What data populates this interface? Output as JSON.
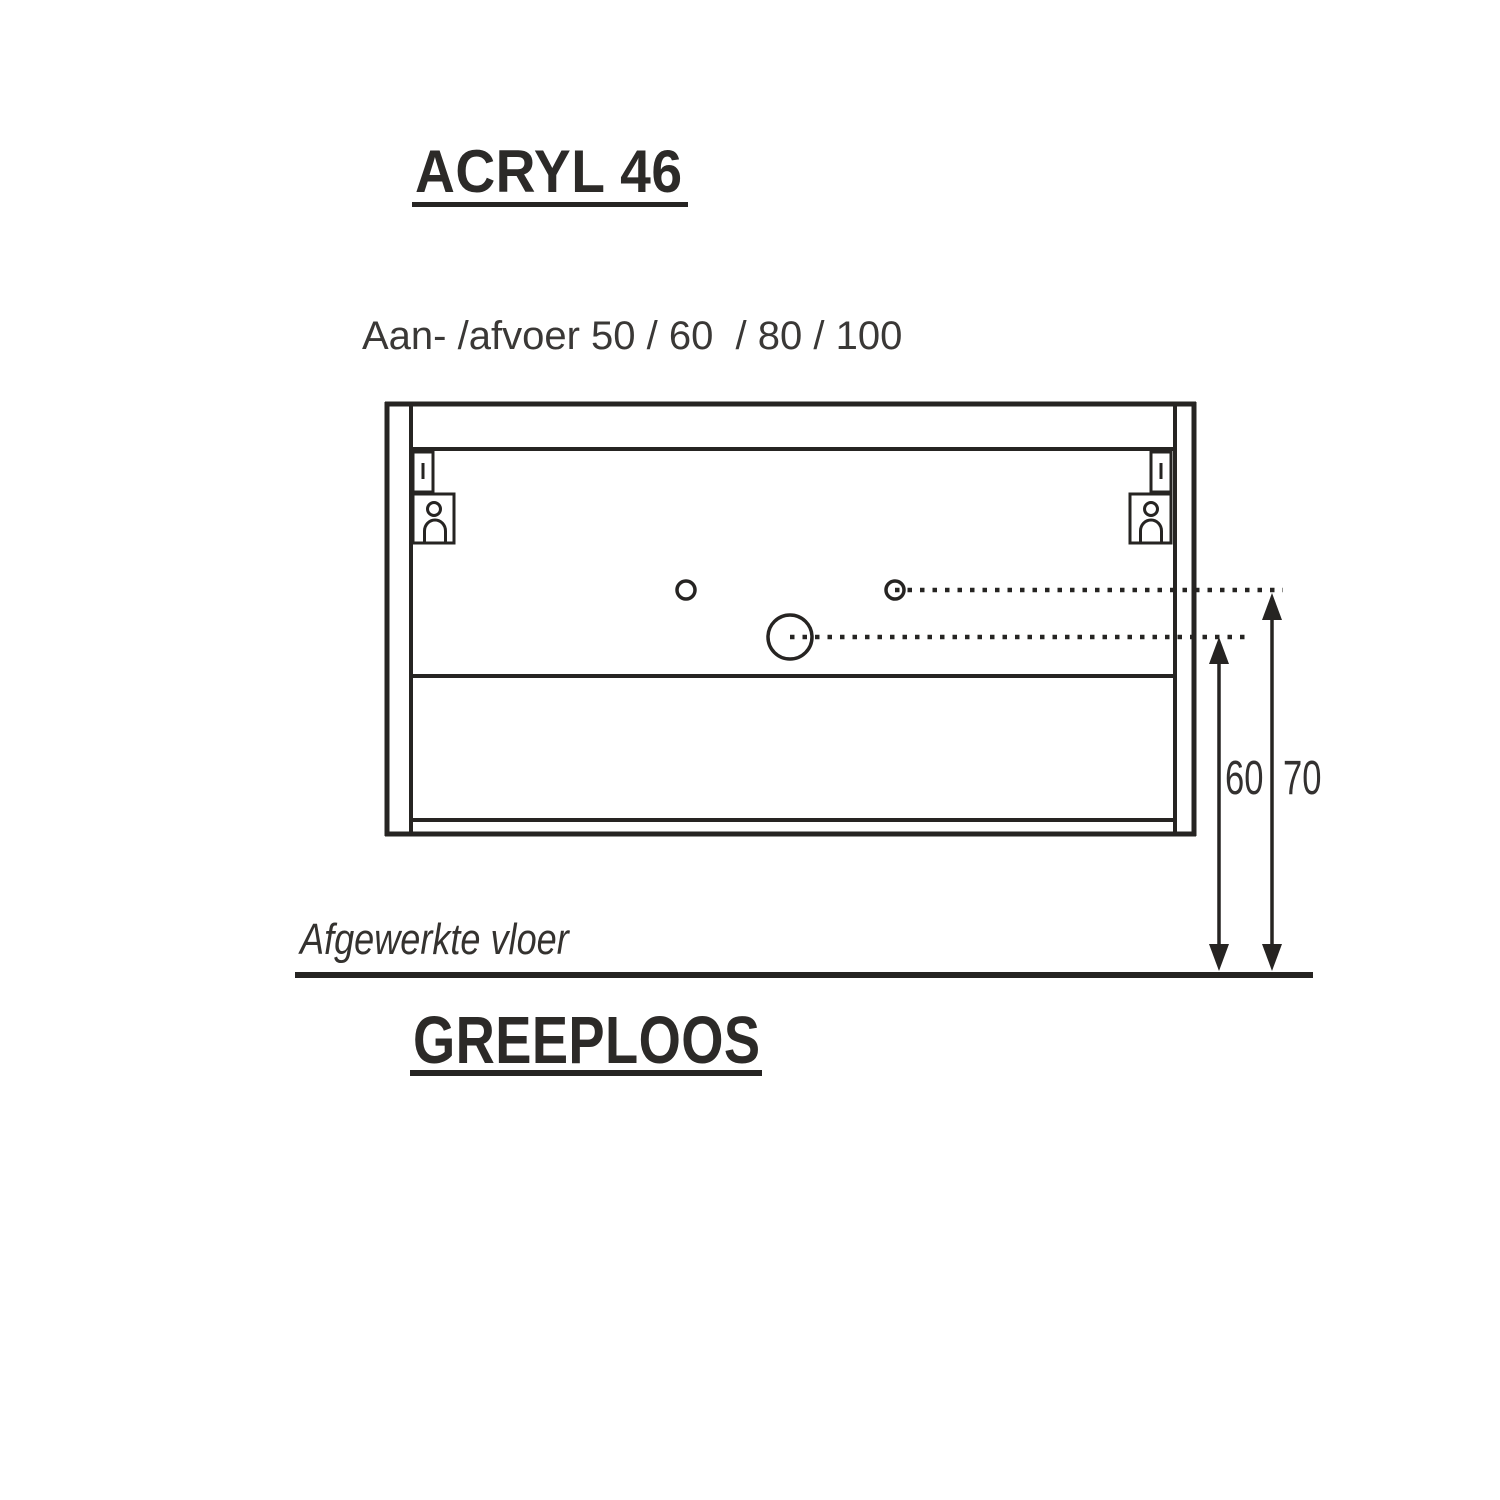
{
  "header": {
    "title": "ACRYL 46"
  },
  "diagram": {
    "connection_label": "Aan- /afvoer 50 / 60  / 80 / 100",
    "floor_label": "Afgewerkte vloer",
    "dimension_left": "60",
    "dimension_right": "70"
  },
  "footer": {
    "title": "GREEPLOOS"
  },
  "colors": {
    "ink": "#2c2a28",
    "text": "#3a3836",
    "line": "#262422",
    "background": "#ffffff"
  }
}
